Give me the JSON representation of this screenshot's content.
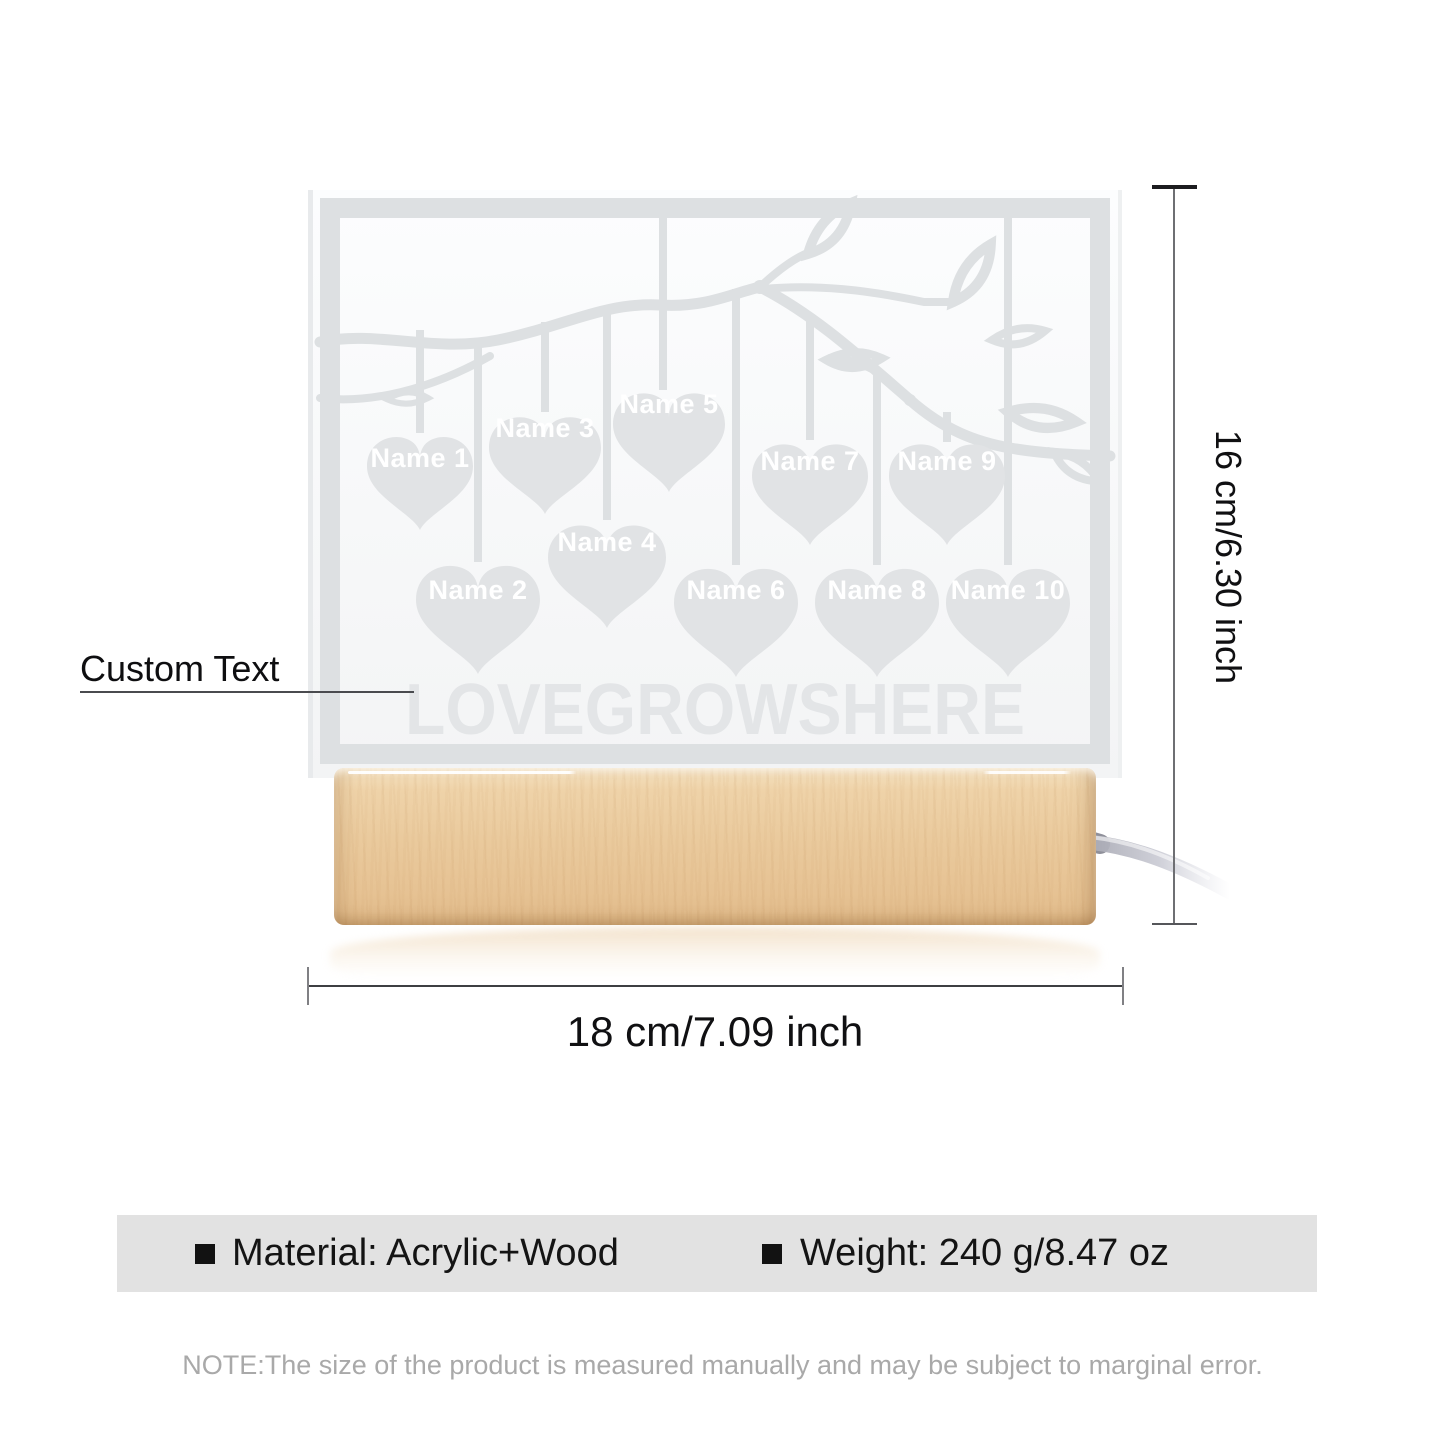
{
  "product": {
    "panel": {
      "title": "LOVEGROWSHERE",
      "names": [
        "Name 1",
        "Name 2",
        "Name 3",
        "Name 4",
        "Name 5",
        "Name 6",
        "Name 7",
        "Name 8",
        "Name 9",
        "Name 10"
      ],
      "engraving_color": "#dde0e2",
      "heart_color": "#e1e3e5",
      "name_text_color": "#ffffff"
    },
    "base": {
      "wood_color": "#eaca9d"
    }
  },
  "annotations": {
    "custom_text_label": "Custom Text",
    "height_label": "16 cm/6.30 inch",
    "width_label": "18 cm/7.09 inch",
    "line_color": "#55565a"
  },
  "specs": {
    "bar_color": "#e2e2e2",
    "items": [
      {
        "label": "Material: Acrylic+Wood"
      },
      {
        "label": "Weight: 240 g/8.47 oz"
      }
    ]
  },
  "note": "NOTE:The size of the product is measured manually and may be subject to marginal error."
}
